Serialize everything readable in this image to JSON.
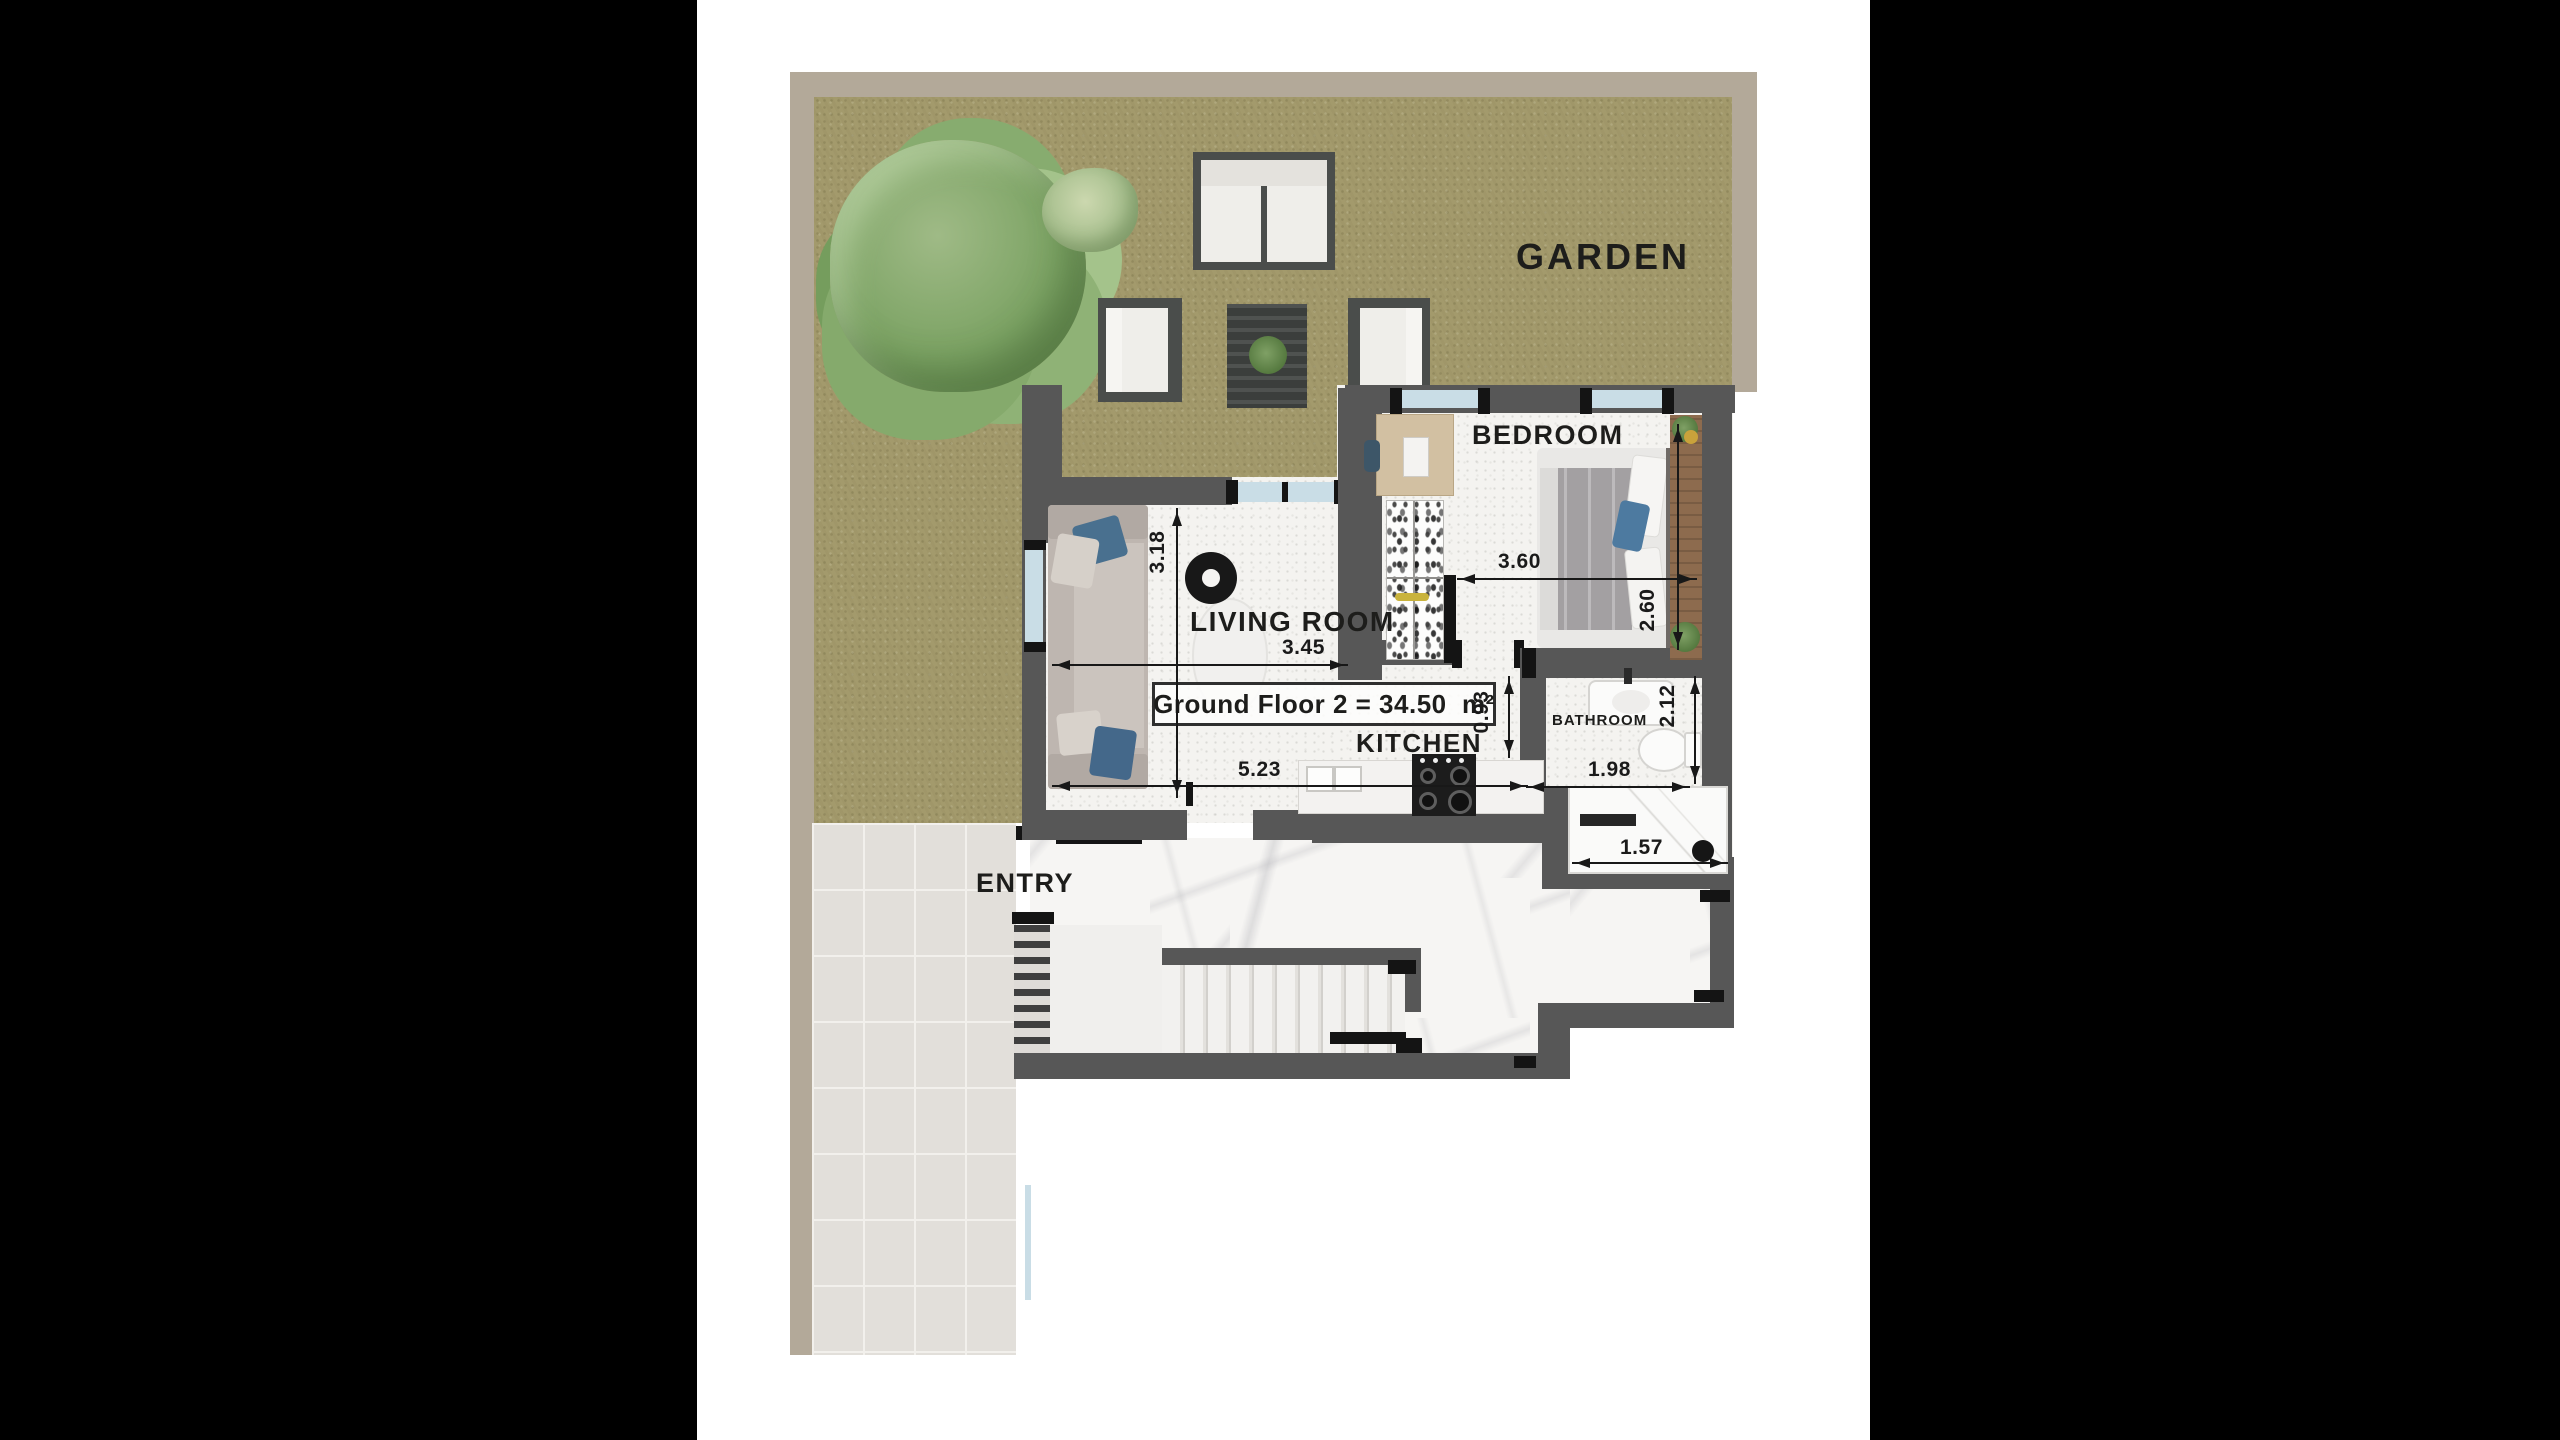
{
  "floor_plan": {
    "area_label": "Ground Floor 2 = 34.50  m²",
    "rooms": {
      "garden": {
        "label": "GARDEN"
      },
      "bedroom": {
        "label": "BEDROOM",
        "width_m": "3.60",
        "depth_m": "2.60"
      },
      "living_room": {
        "label": "LIVING ROOM",
        "width_m": "3.45",
        "depth_m": "3.18",
        "overall_width_m": "5.23"
      },
      "kitchen": {
        "label": "KITCHEN"
      },
      "bathroom": {
        "label": "BATHROOM",
        "width_m": "1.98",
        "depth_m": "2.12",
        "hall_depth_m": "0.93",
        "shower_width_m": "1.57"
      },
      "entry": {
        "label": "ENTRY"
      }
    },
    "colors": {
      "wall": "#575757",
      "garden_grass": "#a39a6c",
      "boundary_wall": "#b3a999",
      "window_glass": "#c9dde6",
      "floor_marble": "#f6f5f3",
      "patio_tile": "#e2dfda",
      "accent_pillow_blue": "#49708f",
      "wood": "#c8ad85"
    }
  }
}
